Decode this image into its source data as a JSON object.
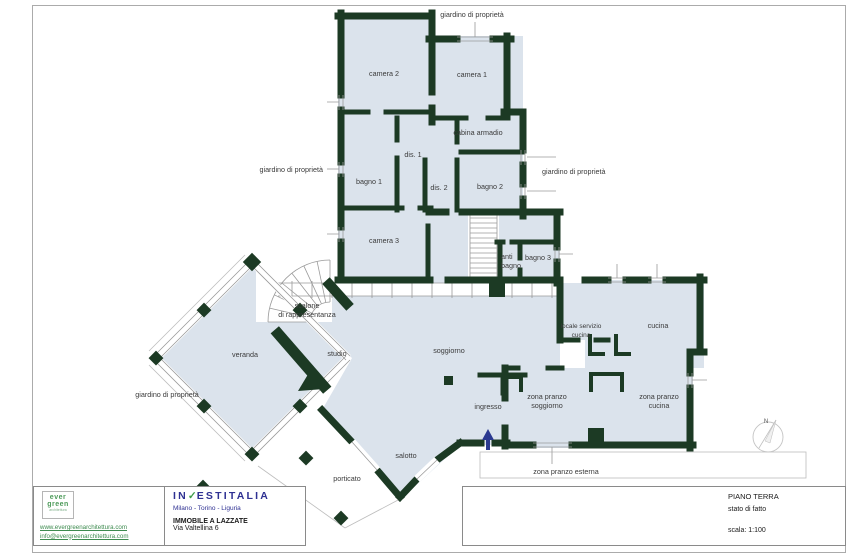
{
  "colors": {
    "wall_green": "#1c3a24",
    "floor_blue": "#dbe3ec",
    "logo_navy": "#2e3092",
    "check_green": "#3f9c49",
    "evergreen_green": "#4c9a59",
    "arrow_blue": "#2b3990"
  },
  "plan": {
    "labels": {
      "camera1": "camera 1",
      "camera2": "camera 2",
      "camera3": "camera 3",
      "cabina_armadio": "cabina armadio",
      "bagno1": "bagno 1",
      "bagno2": "bagno 2",
      "bagno3": "bagno 3",
      "anti_bagno_l1": "anti",
      "anti_bagno_l2": "bagno",
      "dis1": "dis. 1",
      "dis2": "dis. 2",
      "scalone_l1": "scalone",
      "scalone_l2": "di rappresentanza",
      "veranda": "veranda",
      "studio": "studio",
      "soggiorno": "soggiorno",
      "ingresso": "ingresso",
      "salotto": "salotto",
      "porticato": "porticato",
      "locale_servizio_l1": "locale servizio",
      "locale_servizio_l2": "cucina",
      "cucina": "cucina",
      "zp_soggiorno_l1": "zona pranzo",
      "zp_soggiorno_l2": "soggiorno",
      "zp_cucina_l1": "zona pranzo",
      "zp_cucina_l2": "cucina",
      "zp_esterna": "zona pranzo esterna",
      "giardino_top": "giardino di proprietà",
      "giardino_left": "giardino di proprietà",
      "giardino_right": "giardino di proprietà",
      "giardino_bottom": "giardino di proprietà"
    },
    "compass": "N"
  },
  "titleblock": {
    "logo_line1": "ever",
    "logo_line2": "green",
    "logo_sub": "architettura",
    "website": "www.evergreenarchitettura.com",
    "email": "info@evergreenarchitettura.com",
    "company_prefix": "IN",
    "company_suffix": "ESTITALIA",
    "company_check": "✓",
    "company_cities": "Milano - Torino - Liguria",
    "project": "IMMOBILE A LAZZATE",
    "address": "Via Valtellina 6",
    "sheet_title": "PIANO TERRA",
    "sheet_status": "stato di fatto",
    "scale": "scala: 1:100"
  }
}
